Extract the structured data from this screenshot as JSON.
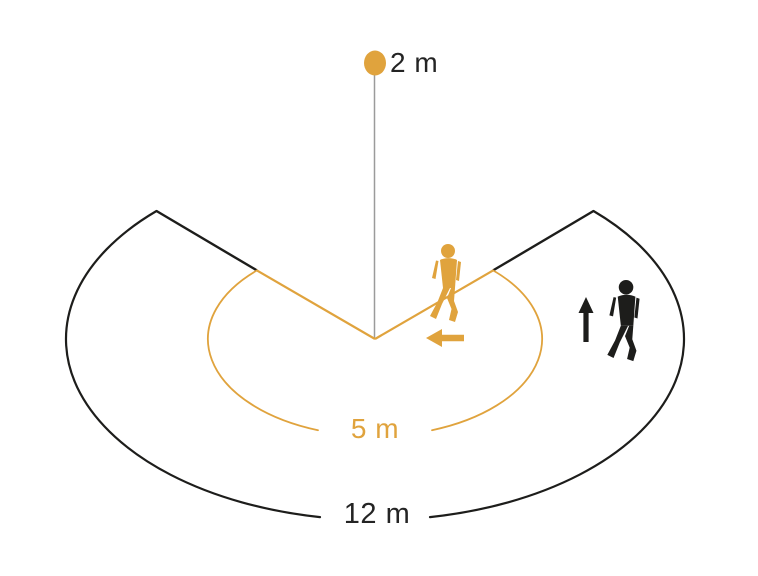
{
  "diagram": {
    "labels": {
      "mounting_height": "2 m",
      "inner_range": "5 m",
      "outer_range": "12 m"
    },
    "colors": {
      "accent": "#E0A33D",
      "ink": "#1d1d1b",
      "guide_line": "#9b9b9b",
      "background": "#ffffff"
    },
    "icons": {
      "sensor": "sensor-dot-icon",
      "tangential_walker": "walking-person-icon",
      "tangential_direction": "arrow-left-icon",
      "radial_walker": "walking-person-icon",
      "radial_direction": "arrow-up-icon"
    }
  }
}
